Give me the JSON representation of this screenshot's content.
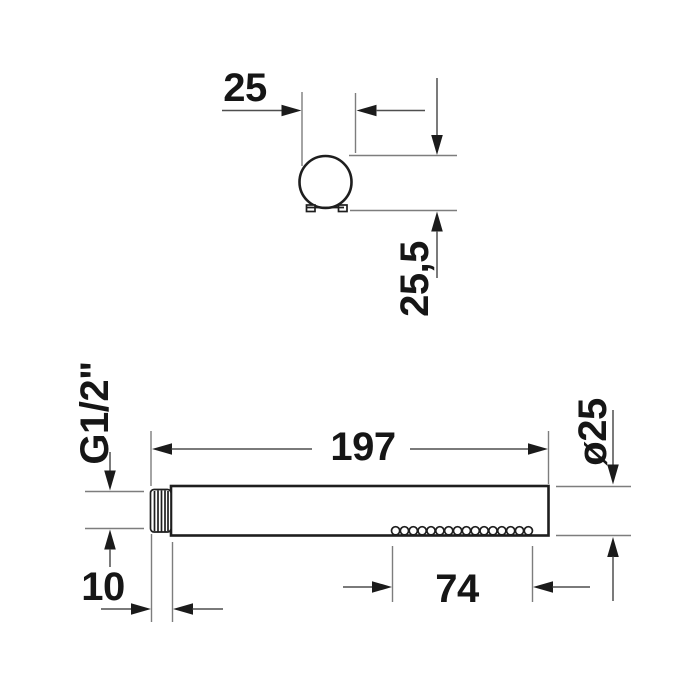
{
  "drawing": {
    "type": "product dimension drawing",
    "subject": "stick hand shower (round profile) - top view and side view",
    "colors": {
      "background": "#ffffff",
      "object_outline": "#1e1e1e",
      "dimension_line": "#4f4f4f",
      "extension_line": "#7d7d7d",
      "text": "#161616"
    },
    "top_view": {
      "dim_diameter": "25",
      "dim_height": "25,5"
    },
    "side_view": {
      "dim_length": "197",
      "dim_thread": "G1/2\"",
      "dim_thread_length": "10",
      "dim_nozzle_field": "74",
      "dim_diameter": "ø25",
      "nozzle_count": 16
    }
  }
}
